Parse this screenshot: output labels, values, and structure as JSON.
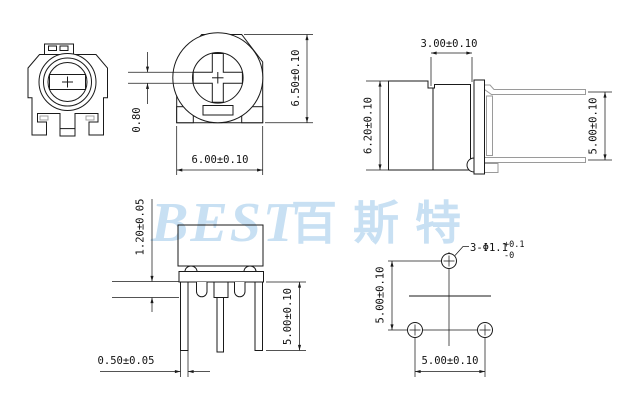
{
  "colors": {
    "line": "#1a1a1a",
    "pin_line": "#9a9a9a",
    "watermark": "#c8e0f3"
  },
  "watermark": {
    "latin": "BEST",
    "cjk": "百斯特"
  },
  "views": {
    "top_view": {
      "dim_width": "6.00±0.10",
      "dim_height": "6.50±0.10",
      "dim_slot": "0.80"
    },
    "side_view": {
      "dim_body": "3.00±0.10",
      "dim_height": "6.20±0.10",
      "dim_pins": "5.00±0.10"
    },
    "front_view": {
      "dim_standoff": "1.20±0.05",
      "dim_pin_length": "5.00±0.10",
      "dim_pin_width": "0.50±0.05"
    },
    "footprint": {
      "dim_vertical": "5.00±0.10",
      "dim_horizontal": "5.00±0.10",
      "hole_label": "3-Φ1.1",
      "hole_tol_plus": "+0.1",
      "hole_tol_minus": "-0"
    }
  }
}
